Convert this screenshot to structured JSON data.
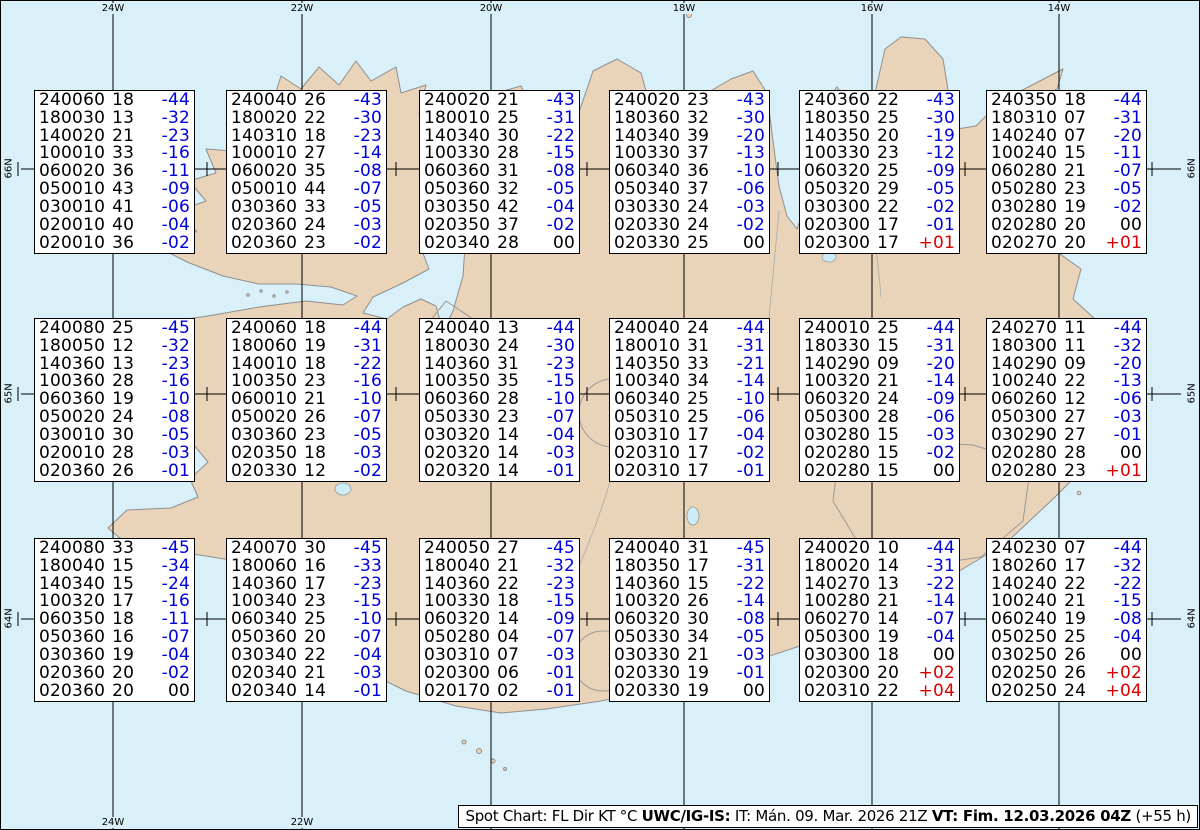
{
  "title": "Spot Chart Iceland",
  "colors": {
    "sea": "#d9f0f8",
    "land": "#e9d4b9",
    "coast": "#8f8f8f",
    "temp_negative": "#0000dd",
    "temp_positive": "#dd0000",
    "temp_zero": "#000000",
    "grid": "#000000",
    "box_bg": "#ffffff"
  },
  "map": {
    "top_labels": [
      "24W",
      "22W",
      "20W",
      "18W",
      "16W",
      "14W"
    ],
    "bottom_labels": [
      "24W",
      "22W"
    ],
    "left_labels": [
      "66N",
      "65N",
      "64N"
    ],
    "right_labels": [
      "66N",
      "65N",
      "64N"
    ]
  },
  "caption": {
    "prefix": "Spot Chart: FL Dir KT °C ",
    "product": "UWC/IG-IS:",
    "issue": " IT: Mán. 09. Mar. 2026 21Z ",
    "valid": "VT: Fim. 12.03.2026 04Z",
    "lead": " (+55 h)"
  },
  "columns_meaning": [
    "FL+Dir",
    "KT",
    "°C"
  ],
  "boxes": [
    [
      [
        "240060",
        "18",
        "-44"
      ],
      [
        "180030",
        "13",
        "-32"
      ],
      [
        "140020",
        "21",
        "-23"
      ],
      [
        "100010",
        "33",
        "-16"
      ],
      [
        "060020",
        "36",
        "-11"
      ],
      [
        "050010",
        "43",
        "-09"
      ],
      [
        "030010",
        "41",
        "-06"
      ],
      [
        "020010",
        "40",
        "-04"
      ],
      [
        "020010",
        "36",
        "-02"
      ]
    ],
    [
      [
        "240040",
        "26",
        "-43"
      ],
      [
        "180020",
        "22",
        "-30"
      ],
      [
        "140310",
        "18",
        "-23"
      ],
      [
        "100010",
        "27",
        "-14"
      ],
      [
        "060020",
        "35",
        "-08"
      ],
      [
        "050010",
        "44",
        "-07"
      ],
      [
        "030360",
        "33",
        "-05"
      ],
      [
        "020360",
        "24",
        "-03"
      ],
      [
        "020360",
        "23",
        "-02"
      ]
    ],
    [
      [
        "240020",
        "21",
        "-43"
      ],
      [
        "180010",
        "25",
        "-31"
      ],
      [
        "140340",
        "30",
        "-22"
      ],
      [
        "100330",
        "28",
        "-15"
      ],
      [
        "060360",
        "31",
        "-08"
      ],
      [
        "050360",
        "32",
        "-05"
      ],
      [
        "030350",
        "42",
        "-04"
      ],
      [
        "020350",
        "37",
        "-02"
      ],
      [
        "020340",
        "28",
        "00"
      ]
    ],
    [
      [
        "240020",
        "23",
        "-43"
      ],
      [
        "180360",
        "32",
        "-30"
      ],
      [
        "140340",
        "39",
        "-20"
      ],
      [
        "100330",
        "37",
        "-13"
      ],
      [
        "060340",
        "36",
        "-10"
      ],
      [
        "050340",
        "37",
        "-06"
      ],
      [
        "030330",
        "24",
        "-03"
      ],
      [
        "020330",
        "24",
        "-02"
      ],
      [
        "020330",
        "25",
        "00"
      ]
    ],
    [
      [
        "240360",
        "22",
        "-43"
      ],
      [
        "180350",
        "25",
        "-30"
      ],
      [
        "140350",
        "20",
        "-19"
      ],
      [
        "100330",
        "23",
        "-12"
      ],
      [
        "060320",
        "25",
        "-09"
      ],
      [
        "050320",
        "29",
        "-05"
      ],
      [
        "030300",
        "22",
        "-02"
      ],
      [
        "020300",
        "17",
        "-01"
      ],
      [
        "020300",
        "17",
        "+01"
      ]
    ],
    [
      [
        "240350",
        "18",
        "-44"
      ],
      [
        "180310",
        "07",
        "-31"
      ],
      [
        "140240",
        "07",
        "-20"
      ],
      [
        "100240",
        "15",
        "-11"
      ],
      [
        "060280",
        "21",
        "-07"
      ],
      [
        "050280",
        "23",
        "-05"
      ],
      [
        "030280",
        "19",
        "-02"
      ],
      [
        "020280",
        "20",
        "00"
      ],
      [
        "020270",
        "20",
        "+01"
      ]
    ],
    [
      [
        "240080",
        "25",
        "-45"
      ],
      [
        "180050",
        "12",
        "-32"
      ],
      [
        "140360",
        "13",
        "-23"
      ],
      [
        "100360",
        "28",
        "-16"
      ],
      [
        "060360",
        "19",
        "-10"
      ],
      [
        "050020",
        "24",
        "-08"
      ],
      [
        "030010",
        "30",
        "-05"
      ],
      [
        "020010",
        "28",
        "-03"
      ],
      [
        "020360",
        "26",
        "-01"
      ]
    ],
    [
      [
        "240060",
        "18",
        "-44"
      ],
      [
        "180060",
        "19",
        "-31"
      ],
      [
        "140010",
        "18",
        "-22"
      ],
      [
        "100350",
        "23",
        "-16"
      ],
      [
        "060010",
        "21",
        "-10"
      ],
      [
        "050020",
        "26",
        "-07"
      ],
      [
        "030360",
        "23",
        "-05"
      ],
      [
        "020350",
        "18",
        "-03"
      ],
      [
        "020330",
        "12",
        "-02"
      ]
    ],
    [
      [
        "240040",
        "13",
        "-44"
      ],
      [
        "180030",
        "24",
        "-30"
      ],
      [
        "140360",
        "31",
        "-23"
      ],
      [
        "100350",
        "35",
        "-15"
      ],
      [
        "060360",
        "28",
        "-10"
      ],
      [
        "050330",
        "23",
        "-07"
      ],
      [
        "030320",
        "14",
        "-04"
      ],
      [
        "020320",
        "14",
        "-03"
      ],
      [
        "020320",
        "14",
        "-01"
      ]
    ],
    [
      [
        "240040",
        "24",
        "-44"
      ],
      [
        "180010",
        "31",
        "-31"
      ],
      [
        "140350",
        "33",
        "-21"
      ],
      [
        "100340",
        "34",
        "-14"
      ],
      [
        "060340",
        "25",
        "-10"
      ],
      [
        "050310",
        "25",
        "-06"
      ],
      [
        "030310",
        "17",
        "-04"
      ],
      [
        "020310",
        "17",
        "-02"
      ],
      [
        "020310",
        "17",
        "-01"
      ]
    ],
    [
      [
        "240010",
        "25",
        "-44"
      ],
      [
        "180330",
        "15",
        "-31"
      ],
      [
        "140290",
        "09",
        "-20"
      ],
      [
        "100320",
        "21",
        "-14"
      ],
      [
        "060320",
        "24",
        "-09"
      ],
      [
        "050300",
        "28",
        "-06"
      ],
      [
        "030280",
        "15",
        "-03"
      ],
      [
        "020280",
        "15",
        "-02"
      ],
      [
        "020280",
        "15",
        "00"
      ]
    ],
    [
      [
        "240270",
        "11",
        "-44"
      ],
      [
        "180300",
        "11",
        "-32"
      ],
      [
        "140290",
        "09",
        "-20"
      ],
      [
        "100240",
        "22",
        "-13"
      ],
      [
        "060260",
        "12",
        "-06"
      ],
      [
        "050300",
        "27",
        "-03"
      ],
      [
        "030290",
        "27",
        "-01"
      ],
      [
        "020280",
        "28",
        "00"
      ],
      [
        "020280",
        "23",
        "+01"
      ]
    ],
    [
      [
        "240080",
        "33",
        "-45"
      ],
      [
        "180040",
        "15",
        "-34"
      ],
      [
        "140340",
        "15",
        "-24"
      ],
      [
        "100320",
        "17",
        "-16"
      ],
      [
        "060350",
        "18",
        "-11"
      ],
      [
        "050360",
        "16",
        "-07"
      ],
      [
        "030360",
        "19",
        "-04"
      ],
      [
        "020360",
        "20",
        "-02"
      ],
      [
        "020360",
        "20",
        "00"
      ]
    ],
    [
      [
        "240070",
        "30",
        "-45"
      ],
      [
        "180060",
        "16",
        "-33"
      ],
      [
        "140360",
        "17",
        "-23"
      ],
      [
        "100340",
        "23",
        "-15"
      ],
      [
        "060340",
        "25",
        "-10"
      ],
      [
        "050360",
        "20",
        "-07"
      ],
      [
        "030340",
        "22",
        "-04"
      ],
      [
        "020340",
        "21",
        "-03"
      ],
      [
        "020340",
        "14",
        "-01"
      ]
    ],
    [
      [
        "240050",
        "27",
        "-45"
      ],
      [
        "180040",
        "21",
        "-32"
      ],
      [
        "140360",
        "22",
        "-23"
      ],
      [
        "100330",
        "18",
        "-15"
      ],
      [
        "060320",
        "14",
        "-09"
      ],
      [
        "050280",
        "04",
        "-07"
      ],
      [
        "030310",
        "07",
        "-03"
      ],
      [
        "020300",
        "06",
        "-01"
      ],
      [
        "020170",
        "02",
        "-01"
      ]
    ],
    [
      [
        "240040",
        "31",
        "-45"
      ],
      [
        "180350",
        "17",
        "-31"
      ],
      [
        "140360",
        "15",
        "-22"
      ],
      [
        "100320",
        "26",
        "-14"
      ],
      [
        "060320",
        "30",
        "-08"
      ],
      [
        "050330",
        "34",
        "-05"
      ],
      [
        "030330",
        "21",
        "-03"
      ],
      [
        "020330",
        "19",
        "-01"
      ],
      [
        "020330",
        "19",
        "00"
      ]
    ],
    [
      [
        "240020",
        "10",
        "-44"
      ],
      [
        "180020",
        "14",
        "-31"
      ],
      [
        "140270",
        "13",
        "-22"
      ],
      [
        "100280",
        "21",
        "-14"
      ],
      [
        "060270",
        "14",
        "-07"
      ],
      [
        "050300",
        "19",
        "-04"
      ],
      [
        "030300",
        "18",
        "00"
      ],
      [
        "020300",
        "20",
        "+02"
      ],
      [
        "020310",
        "22",
        "+04"
      ]
    ],
    [
      [
        "240230",
        "07",
        "-44"
      ],
      [
        "180260",
        "17",
        "-32"
      ],
      [
        "140240",
        "22",
        "-22"
      ],
      [
        "100240",
        "21",
        "-15"
      ],
      [
        "060240",
        "19",
        "-08"
      ],
      [
        "050250",
        "25",
        "-04"
      ],
      [
        "030250",
        "26",
        "00"
      ],
      [
        "020250",
        "26",
        "+02"
      ],
      [
        "020250",
        "24",
        "+04"
      ]
    ]
  ]
}
